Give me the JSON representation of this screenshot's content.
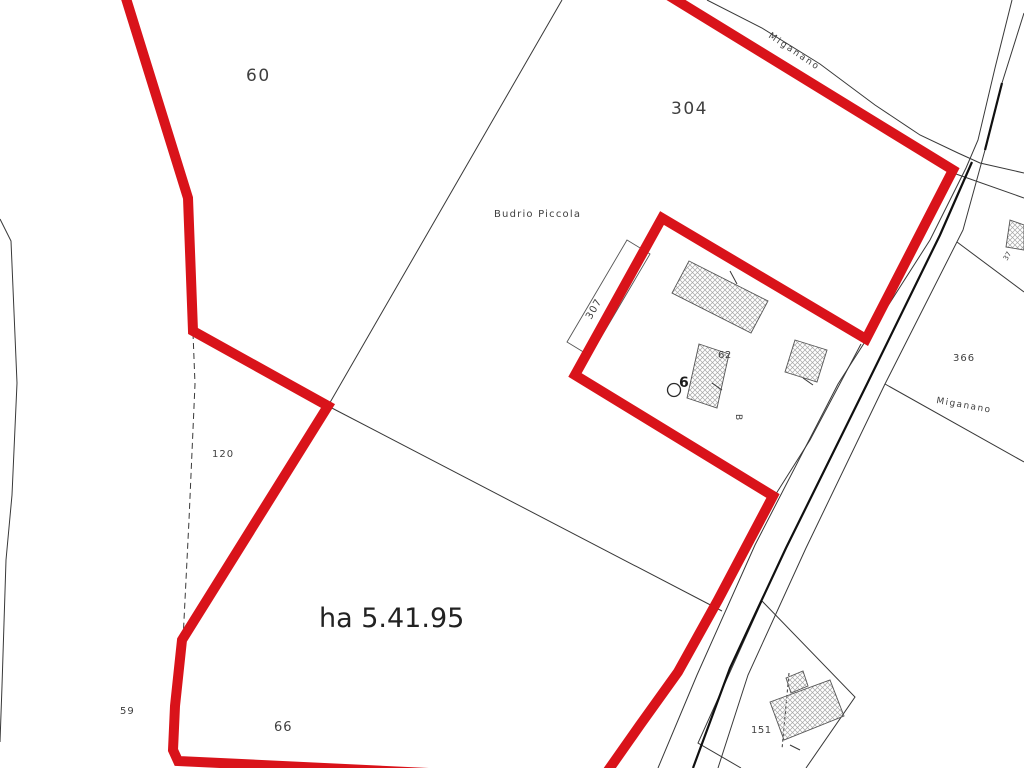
{
  "map": {
    "palette": {
      "background": "#ffffff",
      "red_boundary": "#d9131a",
      "thin_line": "#383838",
      "dark_line": "#101010",
      "building_stroke": "#555555",
      "hatch_stroke": "#a6a6a6",
      "text_color": "#3f3f3f"
    },
    "labels": [
      {
        "name": "parcel-label-60",
        "text": "60",
        "x": 246,
        "y": 81,
        "size": 17,
        "rot": 0,
        "ls": 1.5,
        "bold": false,
        "big": false
      },
      {
        "name": "parcel-label-304",
        "text": "304",
        "x": 671,
        "y": 114,
        "size": 17,
        "rot": 0,
        "ls": 1.5,
        "bold": false,
        "big": false
      },
      {
        "name": "locality-label-budrio-piccola",
        "text": "Budrio Piccola",
        "x": 494,
        "y": 217,
        "size": 10,
        "rot": 0,
        "ls": 1.2,
        "bold": false,
        "big": false
      },
      {
        "name": "parcel-label-307",
        "text": "307",
        "x": 591,
        "y": 320,
        "size": 10,
        "rot": -60,
        "ls": 1,
        "bold": false,
        "big": false
      },
      {
        "name": "parcel-label-62",
        "text": "62",
        "x": 718,
        "y": 358,
        "size": 10,
        "rot": 0,
        "ls": 0.5,
        "bold": false,
        "big": false
      },
      {
        "name": "house-number-label-6",
        "text": "6",
        "x": 679,
        "y": 387,
        "size": 14,
        "rot": 0,
        "ls": 0,
        "bold": true,
        "big": false
      },
      {
        "name": "annotation-label-b",
        "text": "B",
        "x": 736,
        "y": 414,
        "size": 9,
        "rot": 90,
        "ls": 0,
        "bold": false,
        "big": false
      },
      {
        "name": "parcel-label-366",
        "text": "366",
        "x": 953,
        "y": 361,
        "size": 10,
        "rot": 0,
        "ls": 1,
        "bold": false,
        "big": false
      },
      {
        "name": "street-label-miganano-top",
        "text": "Miganano",
        "x": 768,
        "y": 37,
        "size": 9,
        "rot": 34,
        "ls": 2,
        "bold": false,
        "big": false
      },
      {
        "name": "street-label-miganano-right",
        "text": "Miganano",
        "x": 936,
        "y": 403,
        "size": 9,
        "rot": 10,
        "ls": 1.5,
        "bold": false,
        "big": false
      },
      {
        "name": "parcel-label-120",
        "text": "120",
        "x": 212,
        "y": 457,
        "size": 10,
        "rot": 0,
        "ls": 1,
        "bold": false,
        "big": false
      },
      {
        "name": "area-measure-label",
        "text": "ha 5.41.95",
        "x": 319,
        "y": 627,
        "size": 27,
        "rot": 0,
        "ls": 0,
        "bold": false,
        "big": true
      },
      {
        "name": "parcel-label-59",
        "text": "59",
        "x": 120,
        "y": 714,
        "size": 10,
        "rot": 0,
        "ls": 1,
        "bold": false,
        "big": false
      },
      {
        "name": "parcel-label-66",
        "text": "66",
        "x": 274,
        "y": 731,
        "size": 13,
        "rot": 0,
        "ls": 1,
        "bold": false,
        "big": false
      },
      {
        "name": "parcel-label-151",
        "text": "151",
        "x": 751,
        "y": 733,
        "size": 10,
        "rot": 0,
        "ls": 0.5,
        "bold": false,
        "big": false
      },
      {
        "name": "parcel-label-37",
        "text": "37",
        "x": 1007,
        "y": 261,
        "size": 7,
        "rot": -60,
        "ls": 0,
        "bold": false,
        "big": false
      }
    ],
    "red_boundary_paths": [
      {
        "name": "red-boundary-west",
        "d": "M 124 -8 L 188 198 L 193 331 L 328 406 L 182 640 L 175 706 L 173 750 L 178 761 L 575 780"
      },
      {
        "name": "red-boundary-east",
        "d": "M 663 -8 L 953 170 L 866 339 L 662 218 L 575 375 L 773 496 L 718 600 L 678 672 L 640 725 L 607 772"
      }
    ],
    "thin_lines": [
      {
        "name": "parcel-line-west-curvy",
        "d": "M 0 219 L 11 241 L 14 312 L 17 383 L 12 495 L 6 560 L 2 686 L 0 742",
        "dash": ""
      },
      {
        "name": "parcel-line-mid-vertical",
        "d": "M 193 333 L 195 384 L 189 520 L 183 640",
        "dash": "6 4"
      },
      {
        "name": "parcel-line-long-diagonal",
        "d": "M 562 0 L 328 406",
        "dash": ""
      },
      {
        "name": "parcel-line-lower-diagonal",
        "d": "M 328 406 L 722 611",
        "dash": ""
      },
      {
        "name": "road-edge-north",
        "d": "M 707 0 L 762 28 L 820 64 L 875 105 L 920 135 L 958 153 L 980 163 L 1024 173",
        "dash": ""
      },
      {
        "name": "road-edge-south-east",
        "d": "M 956 174 L 1024 198",
        "dash": ""
      },
      {
        "name": "road-edge-ns-west",
        "d": "M 1012 0 L 995 68 L 978 140 L 966 168 L 930 240 L 838 384 L 755 545 L 697 675 L 658 768",
        "dash": ""
      },
      {
        "name": "road-edge-ns-east",
        "d": "M 1024 13 L 1002 83 L 985 150 L 963 230 L 885 384 L 806 548 L 748 675 L 718 768",
        "dash": ""
      },
      {
        "name": "parcel-line-road-sliver",
        "d": "M 861 344 L 810 440 L 774 497",
        "dash": ""
      },
      {
        "name": "parcel-line-366-north",
        "d": "M 957 242 L 1024 292",
        "dash": ""
      },
      {
        "name": "parcel-line-366-south",
        "d": "M 885 384 L 1024 462",
        "dash": ""
      },
      {
        "name": "parcel-line-151",
        "d": "M 806 768 L 855 697 L 762 601 L 698 743 L 741 768",
        "dash": ""
      },
      {
        "name": "building-dashed-division",
        "d": "M 789 673 L 782 749",
        "dash": "3 2.5"
      }
    ],
    "dark_lines": [
      {
        "name": "road-centerline-dark-lower",
        "d": "M 972 162 L 940 235 L 868 382 L 786 548 L 730 668 L 693 768"
      },
      {
        "name": "road-centerline-dark-upper",
        "d": "M 1002 83 L 985 150"
      }
    ],
    "outline_buildings": [
      {
        "name": "building-outline-307",
        "points": "627,240 650,254 590,356 567,342"
      }
    ],
    "hatched_buildings": [
      {
        "name": "building-hatched-main",
        "points": "689,261 768,301 751,333 672,293"
      },
      {
        "name": "building-hatched-62",
        "points": "699,344 729,354 717,408 687,398"
      },
      {
        "name": "building-hatched-small",
        "points": "795,340 827,350 817,382 785,372"
      },
      {
        "name": "building-hatched-151-body",
        "points": "770,702 830,680 844,716 784,740"
      },
      {
        "name": "building-hatched-151-bump",
        "points": "786,678 803,671 808,686 791,693"
      },
      {
        "name": "building-hatched-edge-sliver",
        "points": "1010,220 1024,225 1024,250 1006,247"
      }
    ],
    "tick_marks": [
      {
        "name": "tick-mark-main-building",
        "d": "M 730 271 L 737 284"
      },
      {
        "name": "tick-mark-building-62",
        "d": "M 712 383 L 722 390"
      },
      {
        "name": "tick-mark-small-building",
        "d": "M 803 378 L 813 385"
      },
      {
        "name": "tick-mark-building-151",
        "d": "M 790 745 L 800 750"
      }
    ],
    "well_symbol": {
      "name": "well-symbol",
      "cx": 674,
      "cy": 390,
      "r": 6.5
    }
  }
}
